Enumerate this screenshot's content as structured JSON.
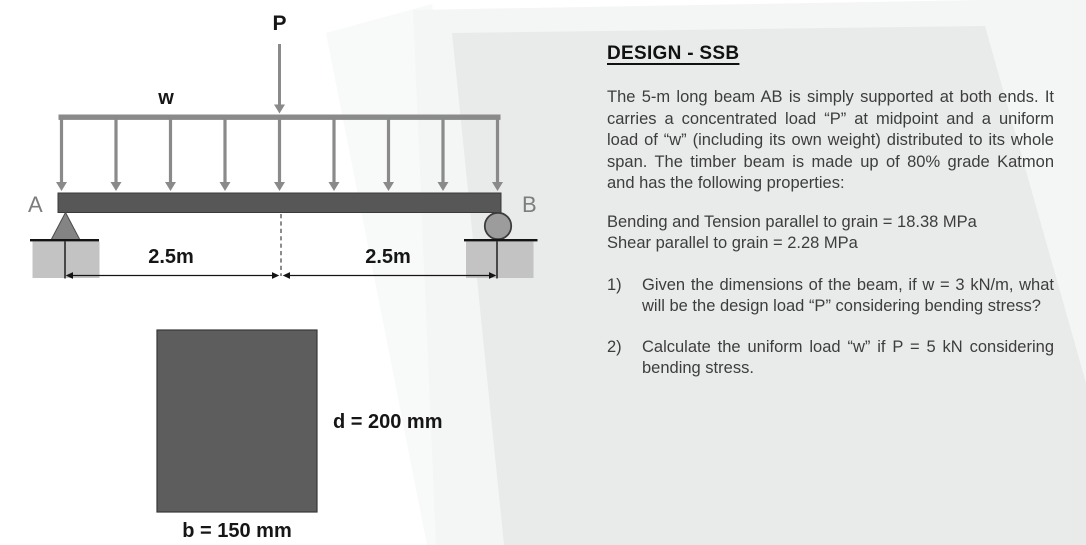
{
  "figure": {
    "point_load_label": "P",
    "udl_label": "w",
    "support_a_label": "A",
    "support_b_label": "B",
    "dim_left_label": "2.5m",
    "dim_right_label": "2.5m",
    "section_depth_label": "d = 200 mm",
    "section_width_label": "b = 150 mm"
  },
  "problem": {
    "title": "DESIGN - SSB",
    "description": "The 5-m long beam AB is simply supported at both ends. It carries a concentrated load “P” at midpoint and a uniform load of “w” (including its own weight) distributed to its whole span. The timber beam is made up of 80% grade Katmon and has the following properties:",
    "properties": [
      "Bending and Tension parallel to grain = 18.38 MPa",
      "Shear parallel to grain = 2.28 MPa"
    ],
    "questions": [
      {
        "number": "1)",
        "text": "Given the dimensions of the beam, if w = 3 kN/m, what will be the design load “P” considering bending stress?"
      },
      {
        "number": "2)",
        "text": "Calculate the uniform load “w” if P = 5 kN considering bending stress."
      }
    ]
  },
  "colors": {
    "beam": "#575757",
    "load_arrows": "#8a8a8a",
    "support_fill": "#8c8c8c",
    "foundation": "#c3c3c3",
    "ground_line": "#141414",
    "panel_gray": "#e9eaea",
    "panel_light": "#f4f5f5",
    "body_text": "#3d3d3d",
    "label_gray": "#7d7d7d"
  }
}
